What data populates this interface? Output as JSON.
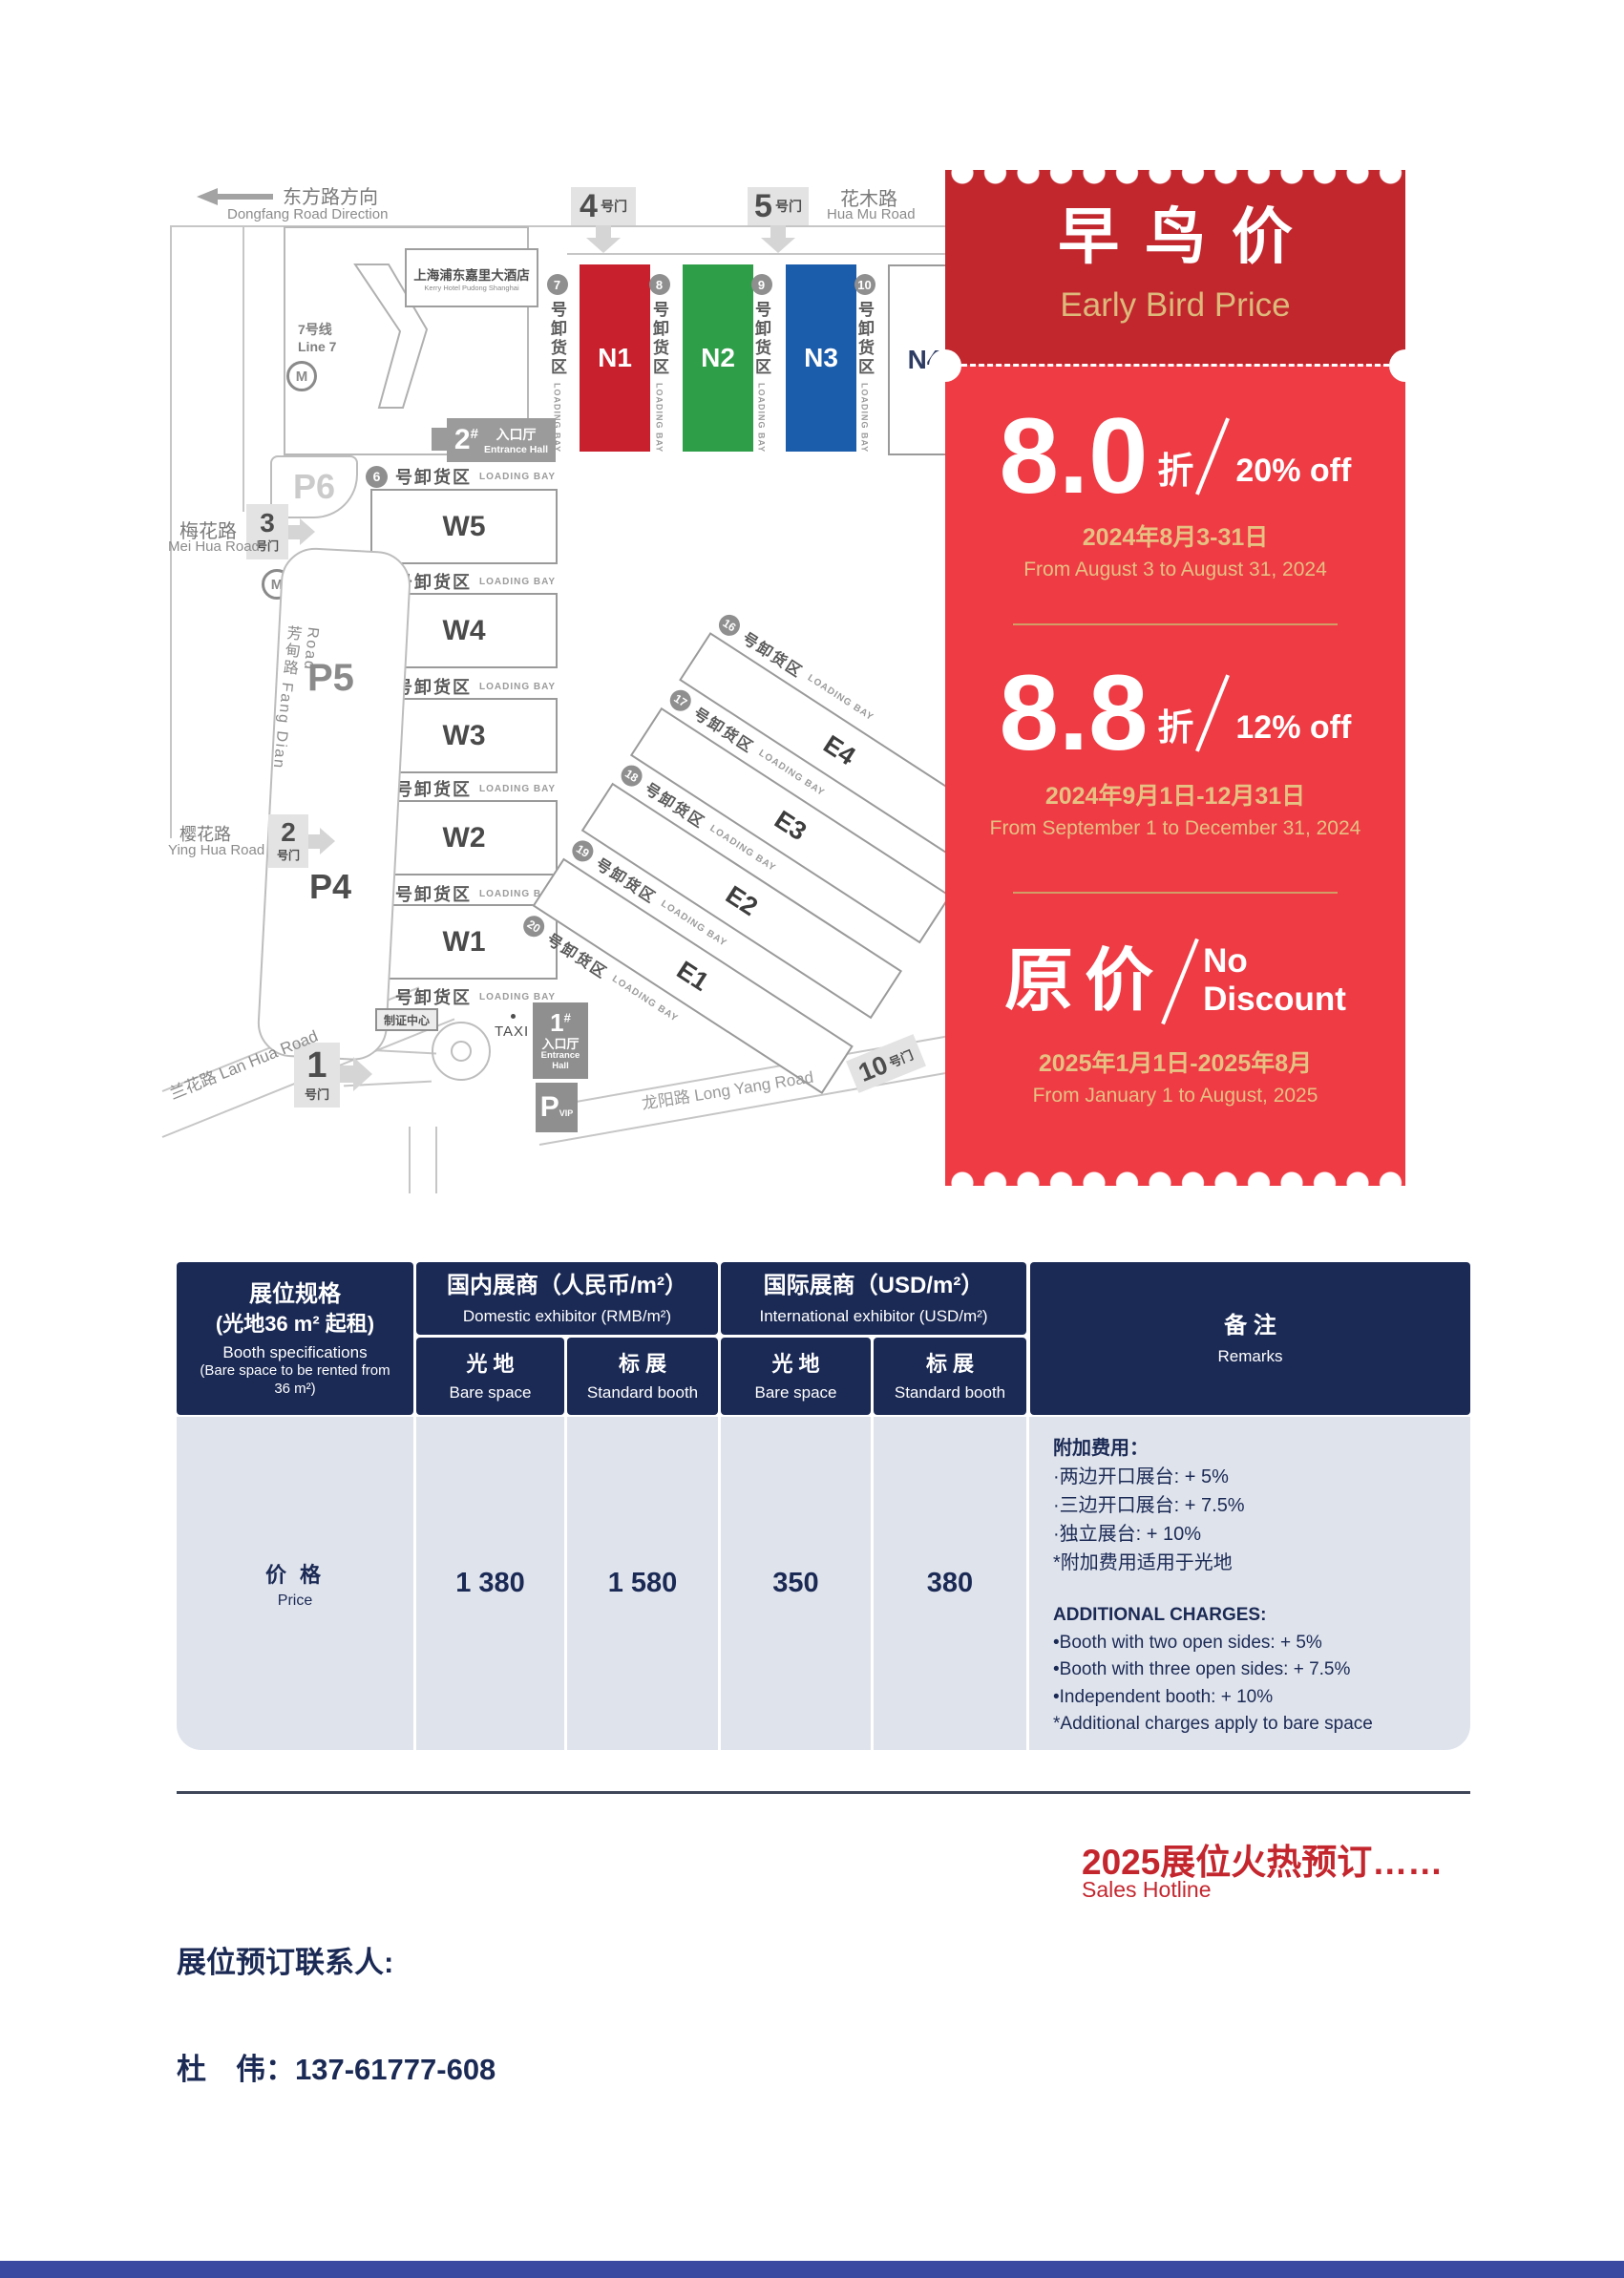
{
  "colors": {
    "ticket_header": "#c1272d",
    "ticket_body": "#ee3b44",
    "ticket_gold": "#ddb97b",
    "table_header_navy": "#1b2a55",
    "table_body_bg": "#dfe3ec",
    "hall_n1_red": "#c8202c",
    "hall_n2_green": "#2f9e49",
    "hall_n3_blue": "#1b5cab",
    "promo_red": "#c4262e",
    "footer_bar_blue": "#3a4aa1"
  },
  "map": {
    "direction": {
      "cn": "东方路方向",
      "en": "Dongfang Road Direction"
    },
    "roads": {
      "huamu_cn": "花木路",
      "huamu_en": "Hua Mu Road",
      "meihua_cn": "梅花路",
      "meihua_en": "Mei Hua Road",
      "fangdian": "芳甸路 Fang Dian Road",
      "yinghua_cn": "樱花路",
      "yinghua_en": "Ying Hua Road",
      "lanhua": "兰花路 Lan Hua Road",
      "longyang": "龙阳路  Long Yang Road"
    },
    "hotel": {
      "cn": "上海浦东嘉里大酒店",
      "en": "Kerry Hotel Pudong Shanghai"
    },
    "metro": {
      "cn": "7号线",
      "en": "Line 7",
      "logo": "M"
    },
    "gate_suffix": "号门",
    "gates": {
      "g1": "1",
      "g2": "2",
      "g3": "3",
      "g4": "4",
      "g5": "5",
      "g10": "10"
    },
    "entrance": {
      "e1_num": "1",
      "e2_num": "2",
      "hash": "#",
      "cn": "入口厅",
      "en": "Entrance Hall"
    },
    "badge_center": "制证中心",
    "taxi": "TAXI",
    "parking": {
      "p4": "P4",
      "p5": "P5",
      "p6": "P6",
      "pvip_letter": "P",
      "pvip_sub": "VIP"
    },
    "bay": {
      "cn": "号卸货区",
      "en": "LOADING BAY"
    },
    "n_halls": [
      {
        "label": "N1",
        "color": "#c8202c"
      },
      {
        "label": "N2",
        "color": "#2f9e49"
      },
      {
        "label": "N3",
        "color": "#1b5cab"
      },
      {
        "label": "N4",
        "color": "#ffffff"
      }
    ],
    "w_halls": [
      "W5",
      "W4",
      "W3",
      "W2",
      "W1"
    ],
    "e_halls": [
      "E4",
      "E3",
      "E2",
      "E1"
    ],
    "n_bays": [
      "7",
      "8",
      "9",
      "10"
    ],
    "w_bays": [
      "6",
      "5",
      "4",
      "3",
      "2",
      "1"
    ],
    "e_bays": [
      "16",
      "17",
      "18",
      "19",
      "20"
    ]
  },
  "ticket": {
    "title_cn": "早鸟价",
    "title_en": "Early Bird Price",
    "tiers": [
      {
        "rate": "8.0",
        "rate_suffix": "折",
        "discount": "20% off",
        "date_cn": "2024年8月3-31日",
        "date_en": "From August 3 to August 31, 2024"
      },
      {
        "rate": "8.8",
        "rate_suffix": "折",
        "discount": "12% off",
        "date_cn": "2024年9月1日-12月31日",
        "date_en": "From September 1 to December 31, 2024"
      },
      {
        "rate": "原价",
        "discount_line1": "No",
        "discount_line2": "Discount",
        "date_cn": "2025年1月1日-2025年8月",
        "date_en": "From January 1 to August, 2025"
      }
    ]
  },
  "table": {
    "col1": {
      "cn1": "展位规格",
      "cn2": "(光地36 m² 起租)",
      "en1": "Booth specifications",
      "en2": "(Bare space to be rented from 36 m²)"
    },
    "domestic": {
      "cn": "国内展商（人民币/m²）",
      "en": "Domestic exhibitor (RMB/m²)"
    },
    "international": {
      "cn": "国际展商（USD/m²）",
      "en": "International exhibitor (USD/m²)"
    },
    "sub": {
      "bare_cn": "光 地",
      "bare_en": "Bare space",
      "std_cn": "标 展",
      "std_en": "Standard booth"
    },
    "remarks": {
      "cn": "备 注",
      "en": "Remarks"
    },
    "row": {
      "label_cn": "价 格",
      "label_en": "Price",
      "values": [
        "1 380",
        "1 580",
        "350",
        "380"
      ]
    },
    "remarks_body": {
      "cn_title": "附加费用：",
      "cn_items": [
        "·两边开口展台: + 5%",
        "·三边开口展台: + 7.5%",
        "·独立展台: + 10%",
        "*附加费用适用于光地"
      ],
      "en_title": "ADDITIONAL CHARGES:",
      "en_items": [
        "•Booth with two open sides: + 5%",
        "•Booth with three open sides: + 7.5%",
        "•Independent booth: + 10%",
        "*Additional charges apply to bare space"
      ]
    }
  },
  "footer": {
    "promo_cn": "2025展位火热预订……",
    "promo_en": "Sales Hotline",
    "contact_label": "展位预订联系人:",
    "contact_line": "杜　伟：137-61777-608"
  }
}
